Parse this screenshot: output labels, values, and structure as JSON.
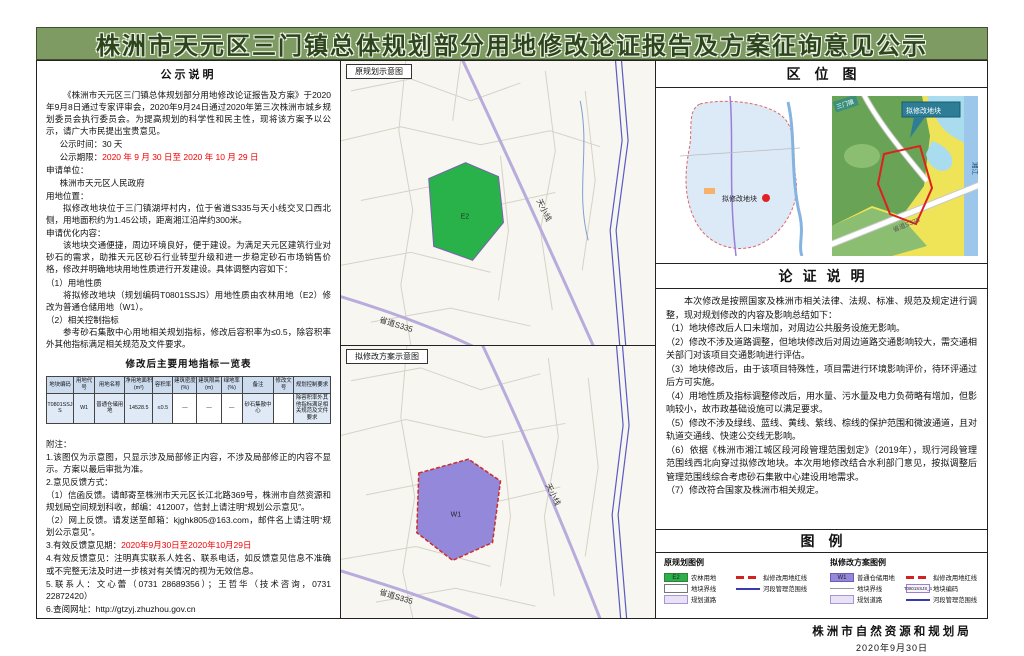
{
  "header": {
    "title": "株洲市天元区三门镇总体规划部分用地修改论证报告及方案征询意见公示"
  },
  "notice": {
    "section_title": "公示说明",
    "para1": "《株洲市天元区三门镇总体规划部分用地修改论证报告及方案》于2020年9月8日通过专家评审会，2020年9月24日通过2020年第三次株洲市城乡规划委员会执行委员会。为提高规划的科学性和民主性，现将该方案予以公示，请广大市民提出宝贵意见。",
    "time_line": "公示时间：30 天",
    "period_label": "公示期限：",
    "period_value": "2020 年 9 月 30 日至 2020 年 10 月 29 日",
    "applicant_label": "申请单位：",
    "applicant_value": "株洲市天元区人民政府",
    "location_label": "用地位置：",
    "location_value": "拟修改地块位于三门镇湖坪村内，位于省道S335与天小线交叉口西北侧，用地面积约为1.45公顷，距离湘江沿岸约300米。",
    "optimize_label": "申请优化内容：",
    "optimize_intro": "该地块交通便捷，周边环境良好，便于建设。为满足天元区建筑行业对砂石的需求，助推天元区砂石行业转型升级和进一步稳定砂石市场销售价格，修改并明确地块用地性质进行开发建设。具体调整内容如下：",
    "item1_title": "（1）用地性质",
    "item1_text": "将拟修改地块（规划编码T0801SSJS）用地性质由农林用地（E2）修改为普通仓储用地（W1）。",
    "item2_title": "（2）相关控制指标",
    "item2_text": "参考砂石集散中心用地相关规划指标，修改后容积率为≤0.5，除容积率外其他指标满足相关规范及文件要求。"
  },
  "table": {
    "title": "修改后主要用地指标一览表",
    "headers": [
      "地块编码",
      "用地代号",
      "用地名称",
      "净用地面积(m²)",
      "容积率",
      "建筑密度(%)",
      "建筑限高(m)",
      "绿地率(%)",
      "备注",
      "修改文号",
      "规划控制要求"
    ],
    "row": [
      "T0801SSJS",
      "W1",
      "普通仓储用地",
      "14528.5",
      "≤0.5",
      "—",
      "—",
      "—",
      "砂石集散中心",
      "",
      "除容积率外其他指标满足相关规范及文件要求"
    ]
  },
  "notes": {
    "label": "附注：",
    "n1": "1.该图仅为示意图，只显示涉及局部修正内容，不涉及局部修正的内容不显示。方案以最后审批为准。",
    "n2": "2.意见反馈方式：",
    "n2a": "（1）信函反馈。请邮寄至株洲市天元区长江北路369号，株洲市自然资源和规划局空间规划科收，邮编：412007，信封上请注明“规划公示意见”。",
    "n2b": "（2）网上反馈。请发送至邮箱：kjghk805@163.com，邮件名上请注明“规划公示意见”。",
    "n3_label": "3.有效反馈意见期：",
    "n3_value": "2020年9月30日至2020年10月29日",
    "n4": "4.有效反馈意见：注明真实联系人姓名、联系电话，如反馈意见信息不准确或不完整无法及时进一步核对有关情况的视为无效信息。",
    "n5": "5.联系人：文心蕾（0731 28689356）；王哲华（技术咨询，0731 22872420）",
    "n6_label": "6.查阅网址：",
    "n6_value": "http://gtzyj.zhuzhou.gov.cn"
  },
  "maps": {
    "original_label": "原规划示意图",
    "proposed_label": "拟修改方案示意图",
    "original_zone": "E2",
    "proposed_zone": "W1",
    "road_tianxiao": "天小线",
    "road_s335": "省道S335"
  },
  "location_map": {
    "title": "区位图",
    "marker_label": "拟修改地块",
    "callout": "拟修改地块",
    "river": "湘江",
    "town": "三门镇",
    "road_s335": "省道S335"
  },
  "argument": {
    "title": "论证说明",
    "intro": "本次修改是按照国家及株洲市相关法律、法规、标准、规范及规定进行调整，现对规划修改的内容及影响总结如下：",
    "p1": "（1）地块修改后人口未增加，对周边公共服务设施无影响。",
    "p2": "（2）修改不涉及道路调整，但地块修改后对周边道路交通影响较大，需交通相关部门对该项目交通影响进行评估。",
    "p3": "（3）地块修改后，由于该项目特殊性，项目需进行环境影响评价，待环评通过后方可实施。",
    "p4": "（4）用地性质及指标调整修改后，用水量、污水量及电力负荷略有增加，但影响较小，故市政基础设施可以满足要求。",
    "p5": "（5）修改不涉及绿线、蓝线、黄线、紫线、棕线的保护范围和微波通道，且对轨道交通线、快速公交线无影响。",
    "p6": "（6）依据《株洲市湘江城区段河段管理范围划定》（2019年），现行河段管理范围线西北向穿过拟修改地块。本次用地修改结合水利部门意见，按拟调整后管理范围线综合考虑砂石集散中心建设用地需求。",
    "p7": "（7）修改符合国家及株洲市相关规定。"
  },
  "legend": {
    "title": "图例",
    "original_title": "原规划图例",
    "proposed_title": "拟修改方案图例",
    "code_e2": "E2",
    "code_w1": "W1",
    "code_block": "T0801SSJS_1",
    "lab_farm": "农林用地",
    "lab_storage": "普通仓储用地",
    "lab_boundary": "地块界线",
    "lab_road": "规划道路",
    "lab_redline": "拟修改用地红线",
    "lab_rivermgmt": "河段管理范围线",
    "lab_blockcode": "地块编码"
  },
  "footer": {
    "org": "株洲市自然资源和规划局",
    "date": "2020年9月30日"
  },
  "colors": {
    "banner_green": "#7d9b63",
    "highlight_red": "#f20000",
    "zone_green": "#2ab24a",
    "zone_purple": "#9488da"
  }
}
